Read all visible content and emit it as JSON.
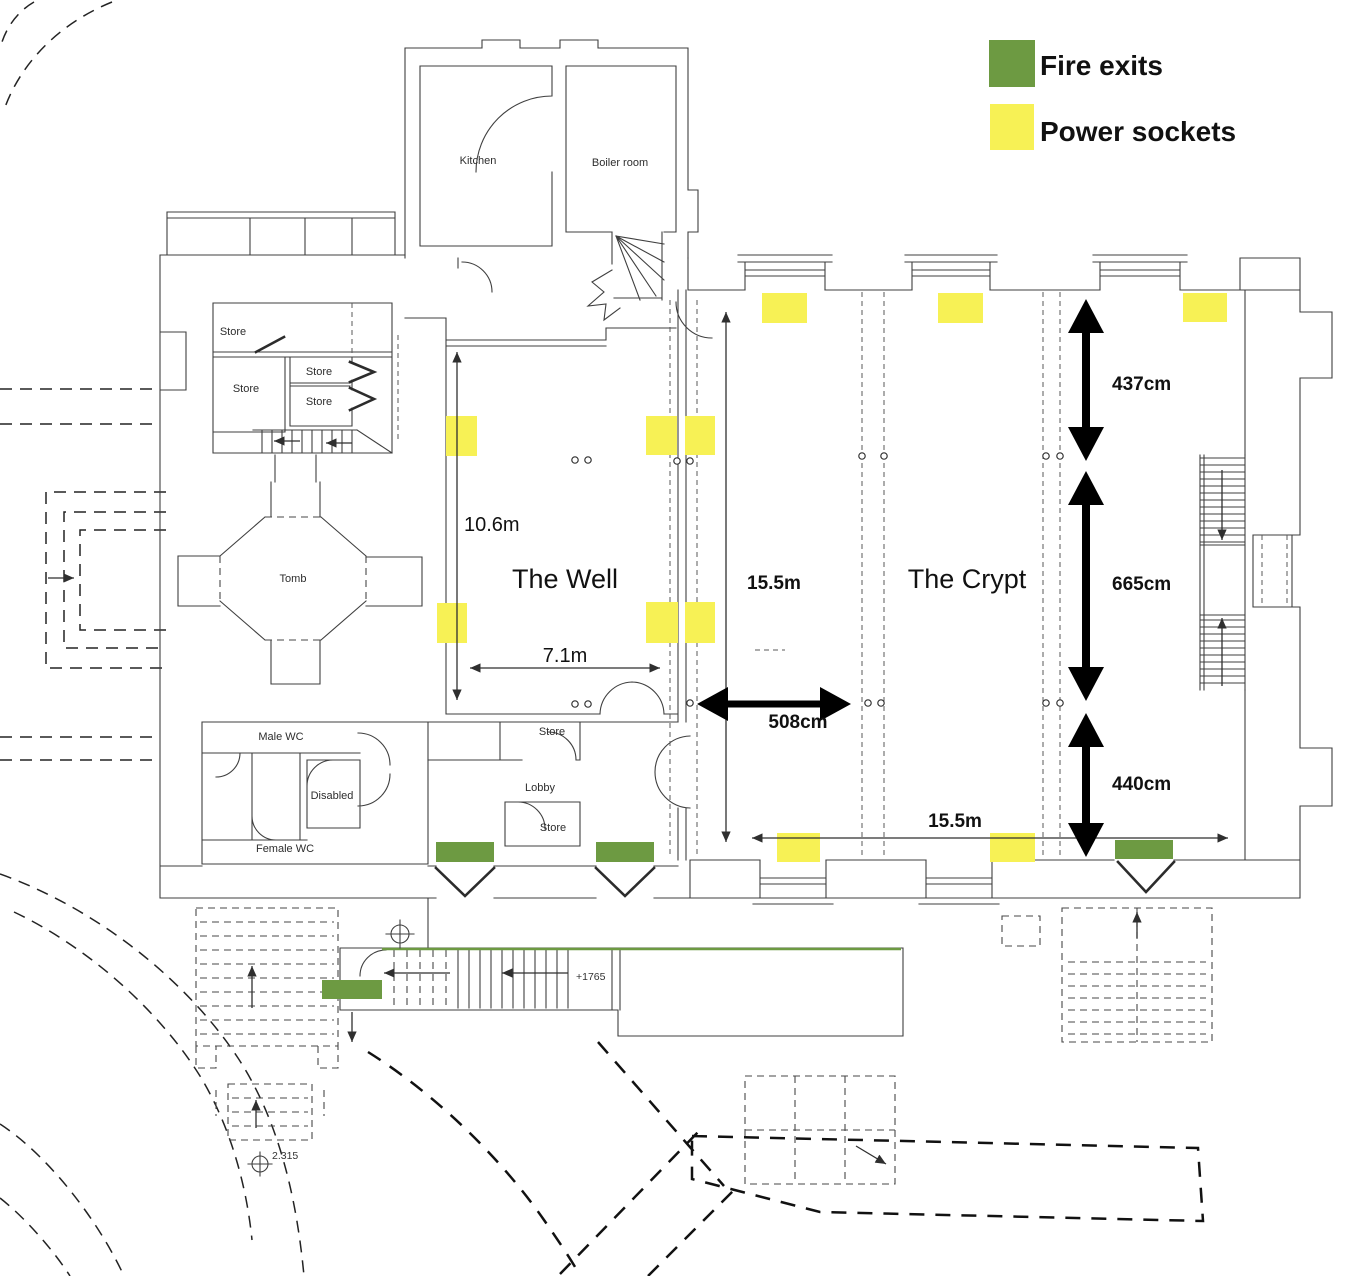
{
  "legend": {
    "items": [
      {
        "id": "fire_exits",
        "label": "Fire exits",
        "color": "#6d9a42"
      },
      {
        "id": "power_sockets",
        "label": "Power sockets",
        "color": "#f7f155"
      }
    ]
  },
  "rooms": {
    "kitchen": "Kitchen",
    "boiler_room": "Boiler room",
    "the_well": "The Well",
    "the_crypt": "The Crypt",
    "tomb": "Tomb",
    "male_wc": "Male WC",
    "disabled": "Disabled",
    "female_wc": "Female WC",
    "lobby": "Lobby",
    "store": "Store"
  },
  "dimensions": {
    "well_length": "10.6m",
    "well_width": "7.1m",
    "crypt_length": "15.5m",
    "crypt_width": "15.5m",
    "bay_span": "508cm",
    "right_section_top": "437cm",
    "right_section_middle": "665cm",
    "right_section_bottom": "440cm"
  },
  "levels": {
    "stair_level": "+1765",
    "datum": "2.315"
  },
  "markers": {
    "fire_exits": [
      {
        "x": 436,
        "y": 842,
        "w": 58,
        "h": 20
      },
      {
        "x": 596,
        "y": 842,
        "w": 58,
        "h": 20
      },
      {
        "x": 1115,
        "y": 840,
        "w": 58,
        "h": 19
      },
      {
        "x": 322,
        "y": 980,
        "w": 60,
        "h": 19
      }
    ],
    "power_sockets": [
      {
        "x": 446,
        "y": 416,
        "w": 31,
        "h": 40
      },
      {
        "x": 646,
        "y": 416,
        "w": 31,
        "h": 39
      },
      {
        "x": 685,
        "y": 416,
        "w": 30,
        "h": 39
      },
      {
        "x": 437,
        "y": 603,
        "w": 30,
        "h": 40
      },
      {
        "x": 646,
        "y": 602,
        "w": 32,
        "h": 41
      },
      {
        "x": 685,
        "y": 602,
        "w": 30,
        "h": 41
      },
      {
        "x": 762,
        "y": 293,
        "w": 45,
        "h": 30
      },
      {
        "x": 938,
        "y": 293,
        "w": 45,
        "h": 30
      },
      {
        "x": 1183,
        "y": 293,
        "w": 44,
        "h": 29
      },
      {
        "x": 777,
        "y": 833,
        "w": 43,
        "h": 29
      },
      {
        "x": 990,
        "y": 833,
        "w": 45,
        "h": 29
      }
    ]
  }
}
